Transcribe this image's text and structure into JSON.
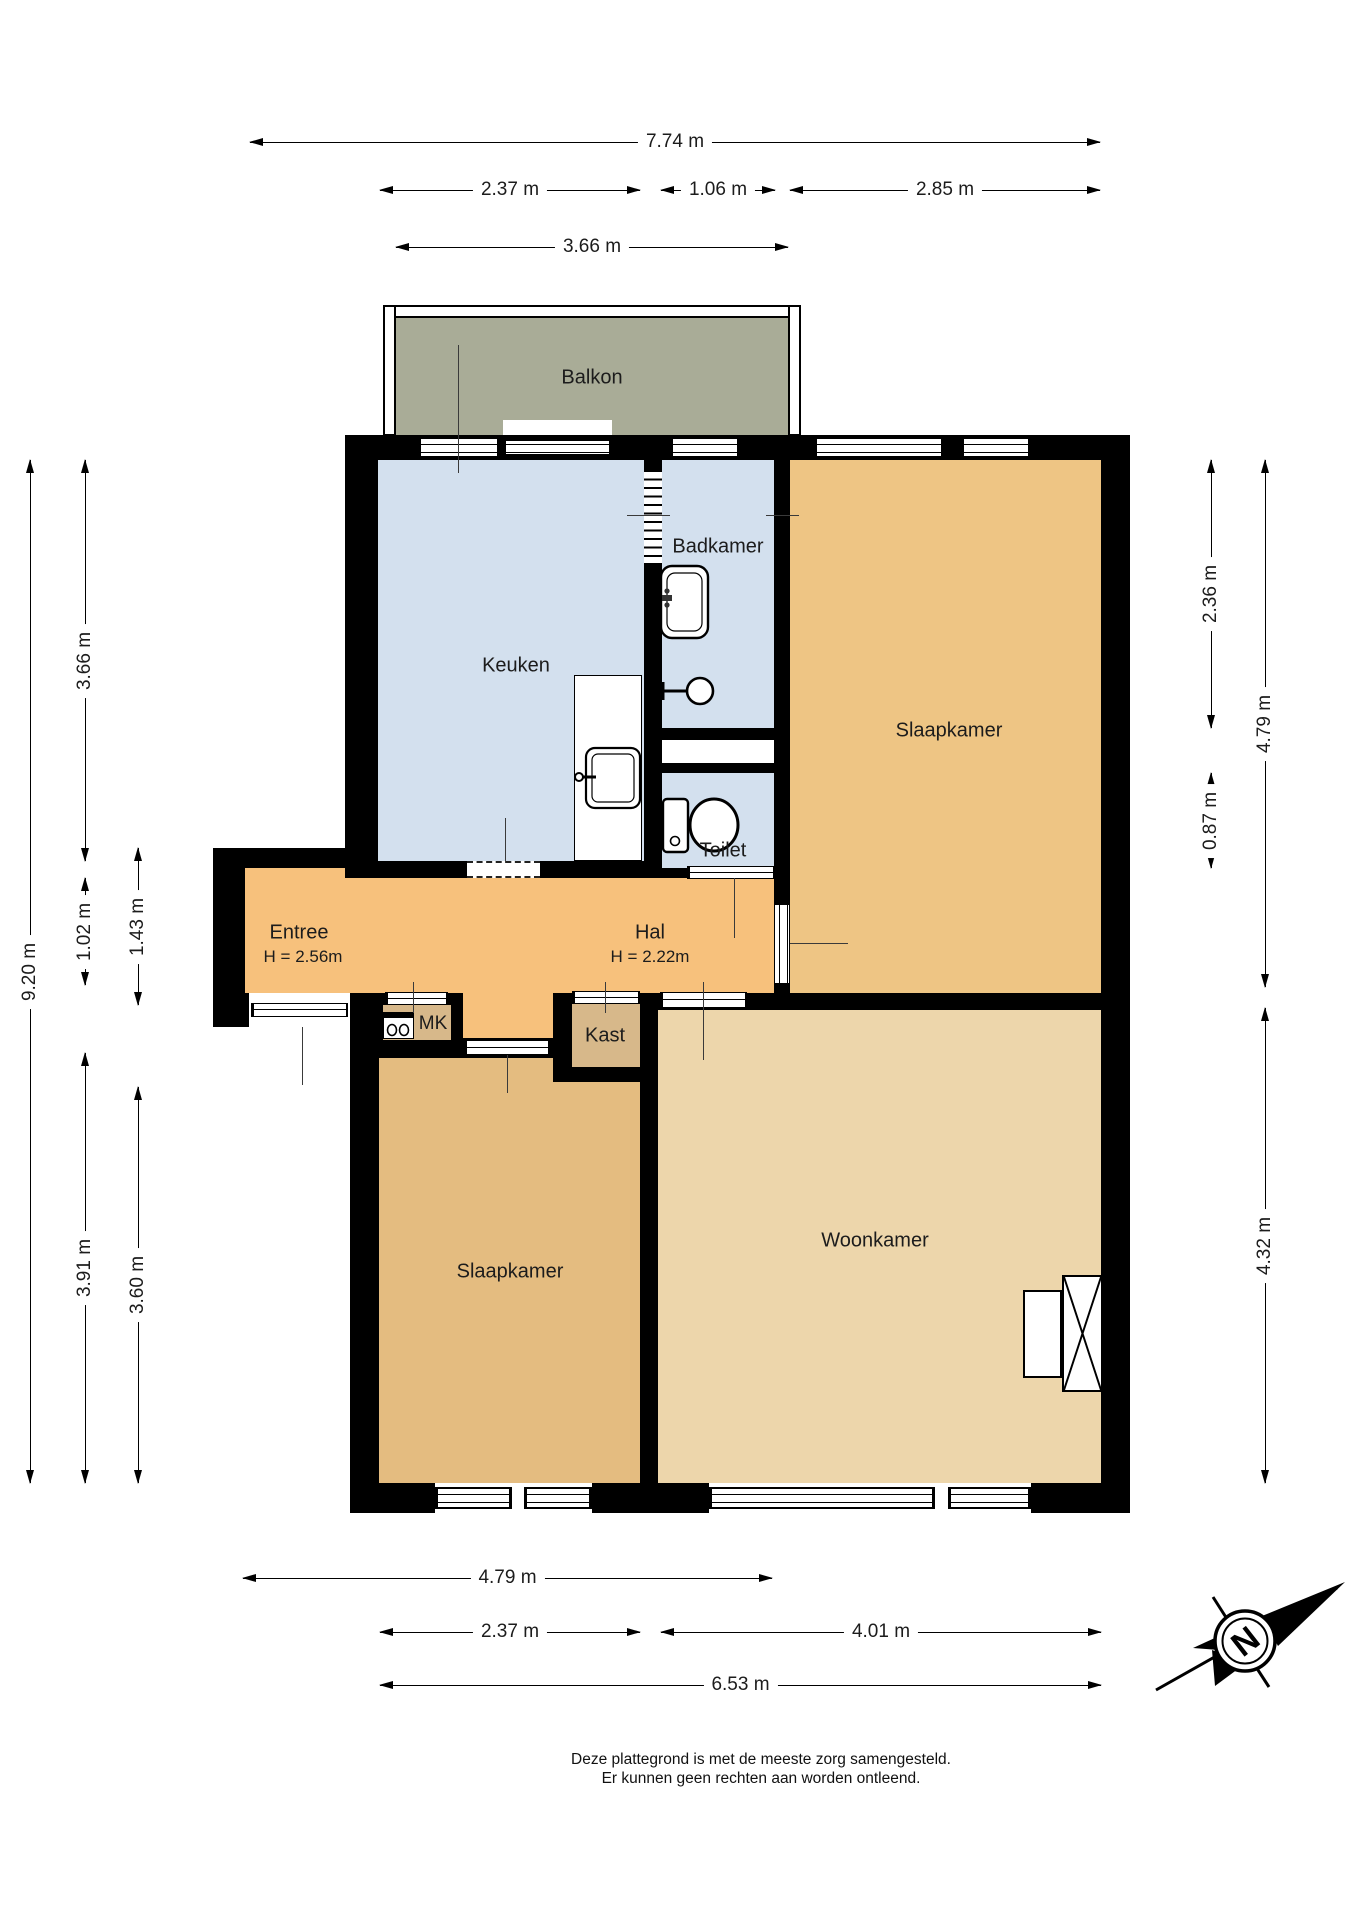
{
  "rooms": [
    {
      "label": "Balkon"
    },
    {
      "label": "Keuken"
    },
    {
      "label": "Badkamer"
    },
    {
      "label": "Slaapkamer"
    },
    {
      "label": "Toilet"
    },
    {
      "label": "Entree",
      "sub": "H = 2.56m"
    },
    {
      "label": "Hal",
      "sub": "H = 2.22m"
    },
    {
      "label": "MK"
    },
    {
      "label": "Kast"
    },
    {
      "label": "Slaapkamer"
    },
    {
      "label": "Woonkamer"
    }
  ],
  "dims": [
    {
      "label": "7.74 m"
    },
    {
      "label": "2.37 m"
    },
    {
      "label": "1.06 m"
    },
    {
      "label": "2.85 m"
    },
    {
      "label": "3.66 m"
    },
    {
      "label": "9.20 m"
    },
    {
      "label": "3.66 m"
    },
    {
      "label": "1.02 m"
    },
    {
      "label": "3.91 m"
    },
    {
      "label": "1.43 m"
    },
    {
      "label": "3.60 m"
    },
    {
      "label": "2.36 m"
    },
    {
      "label": "0.87 m"
    },
    {
      "label": "4.79 m"
    },
    {
      "label": "4.32 m"
    },
    {
      "label": "4.79 m"
    },
    {
      "label": "2.37 m"
    },
    {
      "label": "4.01 m"
    },
    {
      "label": "6.53 m"
    }
  ],
  "compass": {
    "north_label": "N"
  },
  "footer": {
    "line1": "Deze plattegrond is met de meeste zorg samengesteld.",
    "line2": "Er kunnen geen rechten aan worden ontleend."
  },
  "colors": {
    "wall": "#000000",
    "balcony": "#a9ac97",
    "kitchen_bathroom": "#d3e0ee",
    "bedroom_top": "#eec584",
    "hall_entry": "#f7c17c",
    "bedroom_bottom": "#e4bc80",
    "living_room": "#edd6ab",
    "closet": "#d7b88a"
  }
}
